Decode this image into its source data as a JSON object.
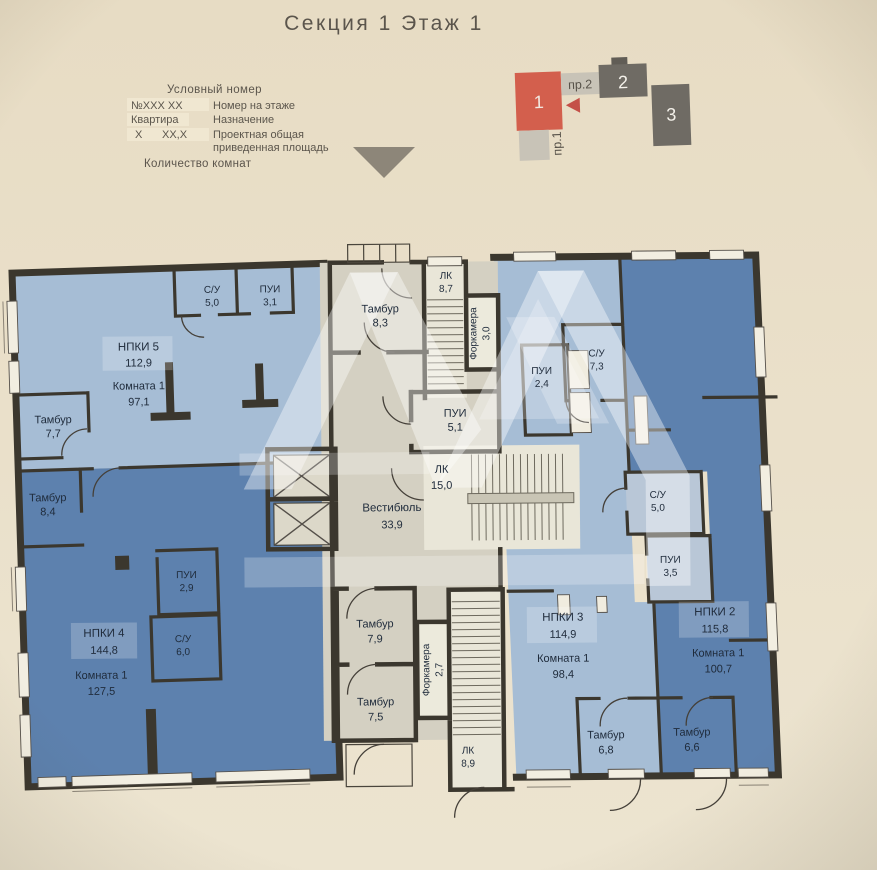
{
  "header": {
    "title": "Секция 1 Этаж 1"
  },
  "legend": {
    "heading": "Условный номер",
    "row1_key": "№XXX  XX",
    "row1_desc": "Номер на этаже",
    "row2_key": "Квартира",
    "row2_desc": "Назначение",
    "row3_key": "X",
    "row3_key2": "XX,X",
    "row3_desc1": "Проектная общая",
    "row3_desc2": "приведенная площадь",
    "footer": "Количество комнат"
  },
  "keyplan": {
    "section1": "1",
    "section2": "2",
    "section3": "3",
    "label_pr2": "пр.2",
    "label_pr1": "пр.1"
  },
  "plan": {
    "colors": {
      "paper": "#e9dfc9",
      "wall": "#3b372e",
      "apartment_light": "#a6bdd5",
      "apartment_dark": "#5d81ae",
      "common": "#d4d0c2",
      "stair": "#e9e6d8",
      "accent_red": "#d35f4d",
      "keyplan_gray": "#6f6b64",
      "keyplan_lightgray": "#c8c3b7"
    },
    "rooms": {
      "su_top": {
        "name": "С/У",
        "area": "5,0"
      },
      "pui_top": {
        "name": "ПУИ",
        "area": "3,1"
      },
      "npki5": {
        "name": "НПКИ 5",
        "area": "112,9"
      },
      "npki5_room": {
        "name": "Комната 1",
        "area": "97,1"
      },
      "tambur77": {
        "name": "Тамбур",
        "area": "7,7"
      },
      "tambur84": {
        "name": "Тамбур",
        "area": "8,4"
      },
      "pui29": {
        "name": "ПУИ",
        "area": "2,9"
      },
      "su60": {
        "name": "С/У",
        "area": "6,0"
      },
      "npki4": {
        "name": "НПКИ 4",
        "area": "144,8"
      },
      "npki4_room": {
        "name": "Комната 1",
        "area": "127,5"
      },
      "tambur83": {
        "name": "Тамбур",
        "area": "8,3"
      },
      "lk87": {
        "name": "ЛК",
        "area": "8,7"
      },
      "fork30": {
        "name": "Форкамера",
        "area": "3,0"
      },
      "pui51": {
        "name": "ПУИ",
        "area": "5,1"
      },
      "vestibule": {
        "name": "Вестибюль",
        "area": "33,9"
      },
      "lk150": {
        "name": "ЛК",
        "area": "15,0"
      },
      "tambur79": {
        "name": "Тамбур",
        "area": "7,9"
      },
      "fork27": {
        "name": "Форкамера",
        "area": "2,7"
      },
      "tambur75": {
        "name": "Тамбур",
        "area": "7,5"
      },
      "lk89": {
        "name": "ЛК",
        "area": "8,9"
      },
      "pui24": {
        "name": "ПУИ",
        "area": "2,4"
      },
      "su73": {
        "name": "С/У",
        "area": "7,3"
      },
      "su50": {
        "name": "С/У",
        "area": "5,0"
      },
      "pui35": {
        "name": "ПУИ",
        "area": "3,5"
      },
      "npki3": {
        "name": "НПКИ 3",
        "area": "114,9"
      },
      "npki3_room": {
        "name": "Комната 1",
        "area": "98,4"
      },
      "npki2": {
        "name": "НПКИ 2",
        "area": "115,8"
      },
      "npki2_room": {
        "name": "Комната 1",
        "area": "100,7"
      },
      "tambur68": {
        "name": "Тамбур",
        "area": "6,8"
      },
      "tambur66": {
        "name": "Тамбур",
        "area": "6,6"
      }
    }
  }
}
